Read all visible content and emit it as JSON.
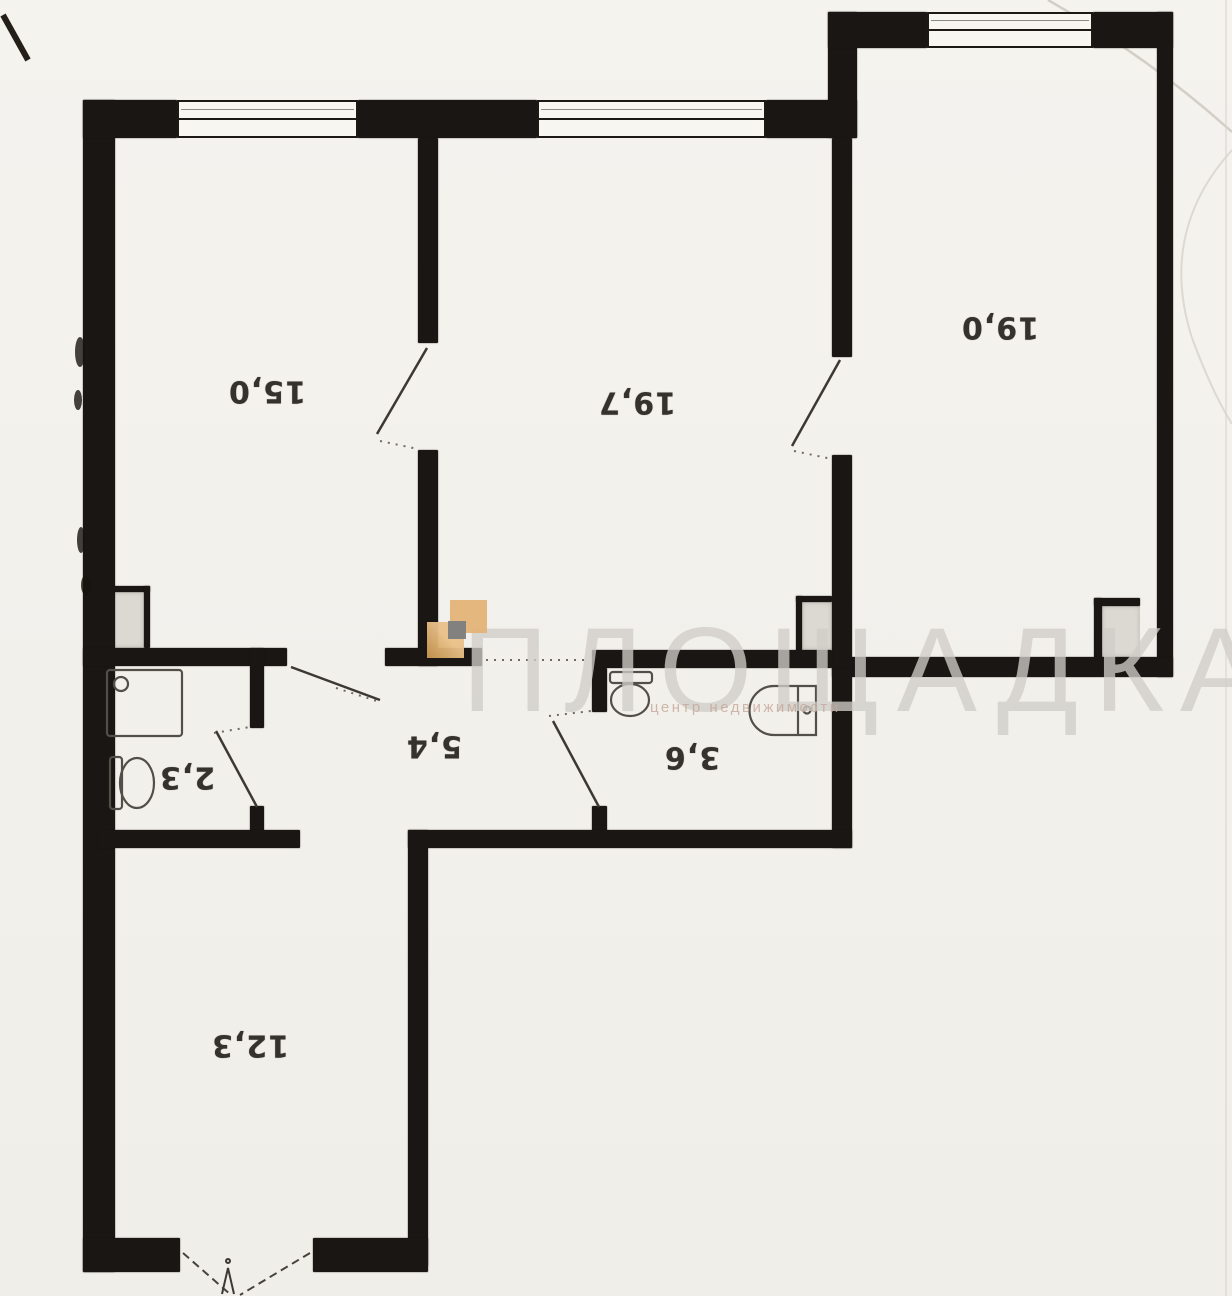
{
  "document": {
    "kind": "scanned apartment floor plan",
    "note": "room area labels are printed rotated 180 degrees"
  },
  "watermark": {
    "brand": "ПЛОЩАДКА",
    "tagline": "центр недвижимости"
  },
  "rooms": [
    {
      "id": "room-top-left",
      "area_label": "15,0"
    },
    {
      "id": "room-top-middle",
      "area_label": "19,7"
    },
    {
      "id": "room-top-right",
      "area_label": "19,0"
    },
    {
      "id": "hallway",
      "area_label": "5,4"
    },
    {
      "id": "bathroom",
      "area_label": "3,6"
    },
    {
      "id": "wc",
      "area_label": "2,3"
    },
    {
      "id": "entrance-room",
      "area_label": "12,3"
    }
  ],
  "colors": {
    "wall": "#1a1614",
    "paper": "#f3f1ec",
    "shaft_fill": "#dcd9d2",
    "logo_tan": "#e2b274",
    "logo_tan_light": "#e9c088",
    "logo_gray": "#7d7c80",
    "watermark_gray": "#cfcdc8",
    "tagline_pink": "#c6a69a"
  }
}
